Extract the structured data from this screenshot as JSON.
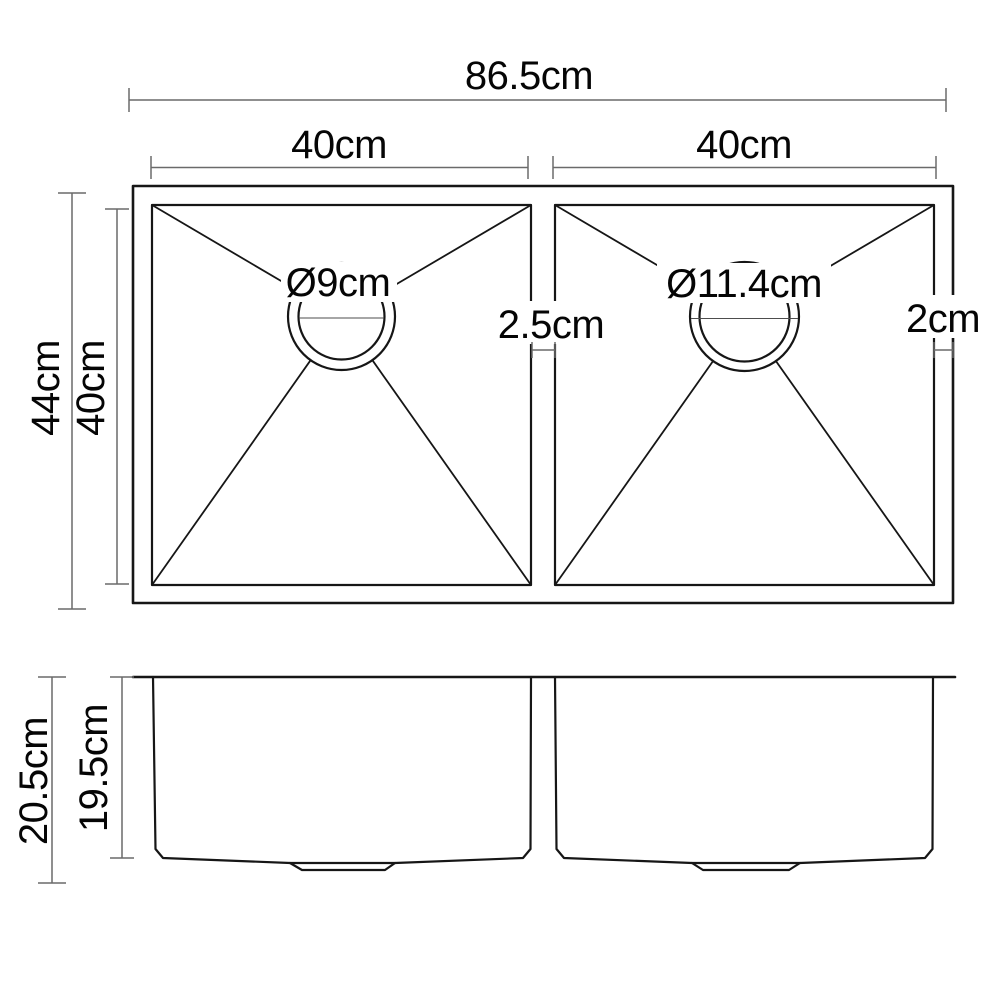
{
  "diagram_title": "Double bowl sink dimension drawing",
  "unit": "cm",
  "colors": {
    "background": "#ffffff",
    "object_line": "#161616",
    "dimension_line": "#6a6a6a",
    "text": "#050505"
  },
  "top_view": {
    "overall_width_label": "86.5cm",
    "left_bowl_width_label": "40cm",
    "right_bowl_width_label": "40cm",
    "overall_depth_label": "44cm",
    "bowl_depth_label": "40cm",
    "left_drain_diameter_label": "Ø9cm",
    "right_drain_diameter_label": "Ø11.4cm",
    "divider_width_label": "2.5cm",
    "right_edge_width_label": "2cm"
  },
  "front_view": {
    "overall_height_label": "20.5cm",
    "bowl_height_label": "19.5cm"
  }
}
